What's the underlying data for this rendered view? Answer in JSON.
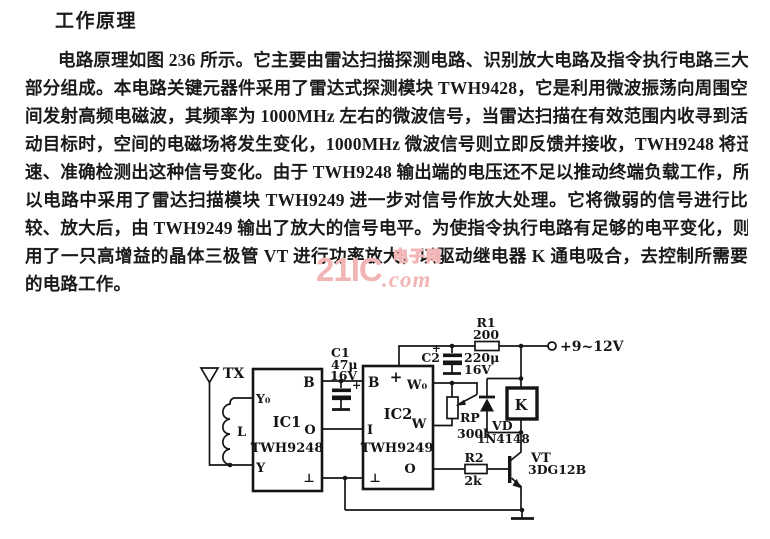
{
  "page": {
    "title": "工作原理"
  },
  "article": {
    "lines": [
      "电路原理如图 236 所示。它主要由雷达扫描探测电路、识别放大电路及指令执行电路三大",
      "部分组成。本电路关键元器件采用了雷达式探测模块 TWH9428，它是利用微波振荡向周围空",
      "间发射高频电磁波，其频率为 1000MHz 左右的微波信号，当雷达扫描在有效范围内收寻到活",
      "动目标时，空间的电磁场将发生变化，1000MHz 微波信号则立即反馈并接收，TWH9248 将迅",
      "速、准确检测出这种信号变化。由于 TWH9248 输出端的电压还不足以推动终端负载工作，所",
      "以电路中采用了雷达扫描模块 TWH9249 进一步对信号作放大处理。它将微弱的信号进行比",
      "较、放大后，由 TWH9249 输出了放大的信号电平。为使指令执行电路有足够的电平变化，则采",
      "用了一只高增益的晶体三极管 VT 进行功率放大，以驱动继电器 K 通电吸合，去控制所需要",
      "的电路工作。"
    ]
  },
  "watermark": {
    "brand": "21IC",
    "site_name": "电子网",
    "domain": ".com"
  },
  "colors": {
    "ink": "#1a1a1a",
    "paper": "#ffffff",
    "watermark_pink": "#f1b5b5"
  },
  "circuit": {
    "labels": {
      "antenna": "TX",
      "coil": "L",
      "ic1_name": "IC1",
      "ic1_part": "TWH9248",
      "ic1_pin_b": "B",
      "ic1_pin_y0": "Y₀",
      "ic1_pin_y": "Y",
      "ic1_pin_o": "O",
      "ic1_pin_gnd": "⊥",
      "ic2_name": "IC2",
      "ic2_part": "TWH9249",
      "ic2_pin_b": "B",
      "ic2_pin_plus": "+",
      "ic2_pin_w0": "W₀",
      "ic2_pin_i": "I",
      "ic2_pin_w": "W",
      "ic2_pin_o": "O",
      "ic2_pin_gnd": "⊥",
      "c1_name": "C1",
      "c1_value": "47μ",
      "c1_voltage": "16V",
      "c1_polarity": "+",
      "c2_name": "C2",
      "c2_value": "220μ",
      "c2_voltage": "16V",
      "c2_polarity": "+",
      "r1_name": "R1",
      "r1_value": "200",
      "r2_name": "R2",
      "r2_value": "2k",
      "rp_name": "RP",
      "rp_value": "300k",
      "vd_name": "VD",
      "vd_part": "1N4148",
      "relay": "K",
      "vt_name": "VT",
      "vt_part": "3DG12B",
      "supply": "+9~12V"
    }
  }
}
